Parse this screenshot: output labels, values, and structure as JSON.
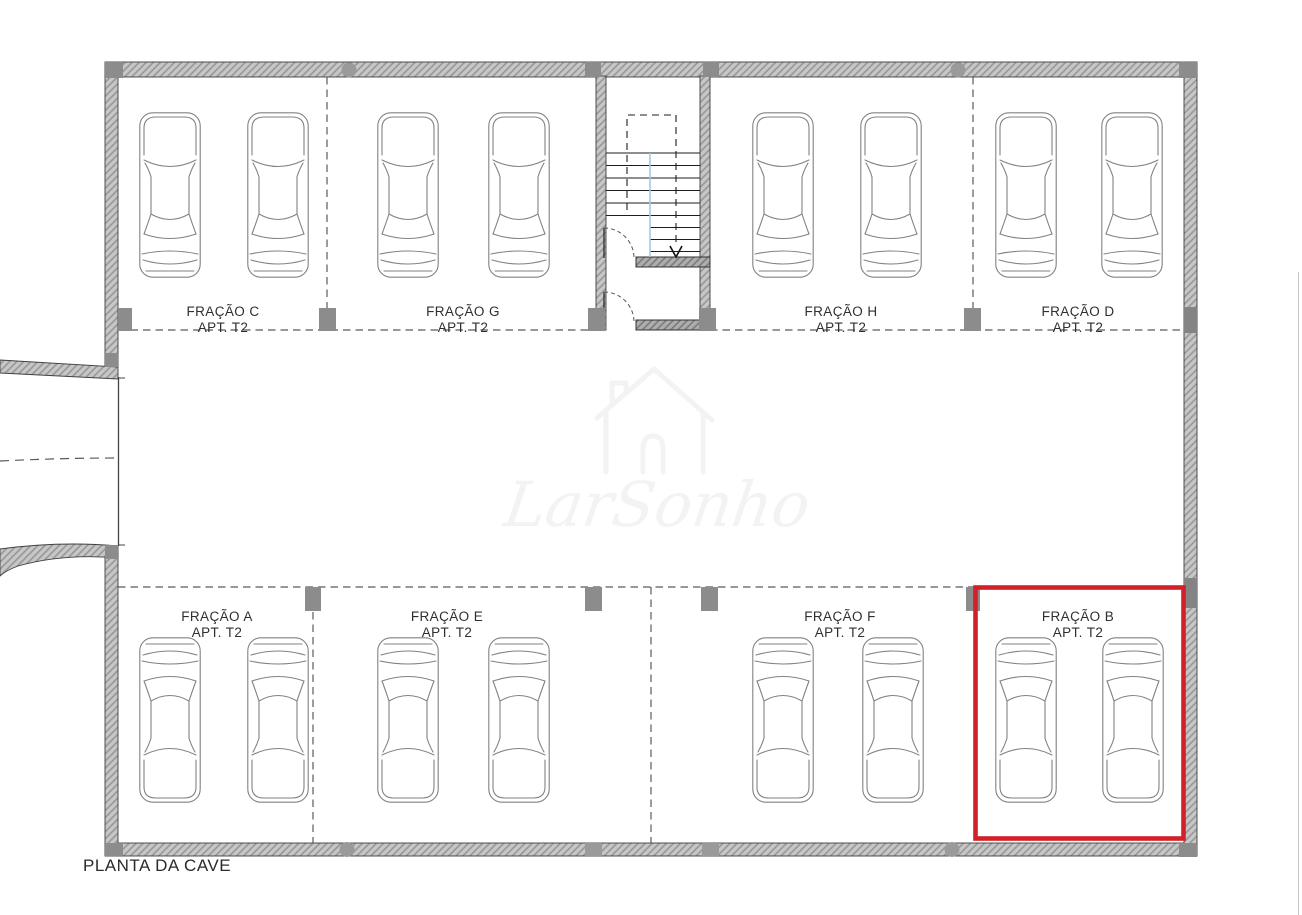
{
  "plan": {
    "title": "PLANTA DA CAVE",
    "watermark": "LarSonho",
    "highlight_color": "#d22027",
    "sections": [
      {
        "id": "C",
        "name": "FRAÇÃO C",
        "apt": "APT. T2",
        "row": "top",
        "cars": 2,
        "highlighted": false
      },
      {
        "id": "G",
        "name": "FRAÇÃO G",
        "apt": "APT. T2",
        "row": "top",
        "cars": 2,
        "highlighted": false
      },
      {
        "id": "H",
        "name": "FRAÇÃO H",
        "apt": "APT. T2",
        "row": "top",
        "cars": 2,
        "highlighted": false
      },
      {
        "id": "D",
        "name": "FRAÇÃO D",
        "apt": "APT. T2",
        "row": "top",
        "cars": 2,
        "highlighted": false
      },
      {
        "id": "A",
        "name": "FRAÇÃO A",
        "apt": "APT. T2",
        "row": "bottom",
        "cars": 2,
        "highlighted": false
      },
      {
        "id": "E",
        "name": "FRAÇÃO E",
        "apt": "APT. T2",
        "row": "bottom",
        "cars": 2,
        "highlighted": false
      },
      {
        "id": "F",
        "name": "FRAÇÃO F",
        "apt": "APT. T2",
        "row": "bottom",
        "cars": 2,
        "highlighted": false
      },
      {
        "id": "B",
        "name": "FRAÇÃO B",
        "apt": "APT. T2",
        "row": "bottom",
        "cars": 2,
        "highlighted": true
      }
    ]
  }
}
